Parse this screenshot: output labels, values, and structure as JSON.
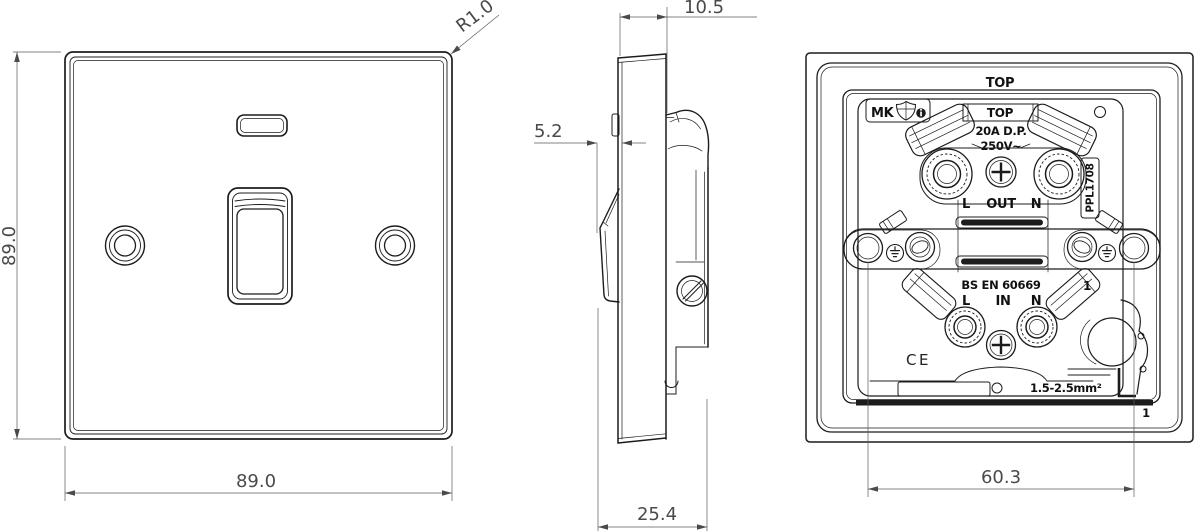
{
  "colors": {
    "line": "#1c1c1c",
    "dimension": "#5a5a5a",
    "background": "#ffffff"
  },
  "views": {
    "front": {
      "dims": {
        "height": "89.0",
        "width": "89.0",
        "corner_radius": "R1.0"
      }
    },
    "side": {
      "dims": {
        "plate_depth": "10.5",
        "rocker_protrusion": "5.2",
        "overall_depth": "25.4"
      }
    },
    "back": {
      "plate_orientation": "TOP",
      "module": {
        "orientation": "TOP",
        "rating": "20A D.P.",
        "voltage": "250V~",
        "brand": "MK",
        "out_l": "L",
        "out_label": "OUT",
        "out_n": "N",
        "in_l": "L",
        "in_label": "IN",
        "in_n": "N",
        "standard": "BS EN 60669",
        "part_code": "PPL1708",
        "cable_range": "1.5-2.5mm²",
        "ce_mark": "CE",
        "marker_upper": "1",
        "marker_lower": "1"
      },
      "dims": {
        "fixing_centres": "60.3"
      }
    }
  }
}
